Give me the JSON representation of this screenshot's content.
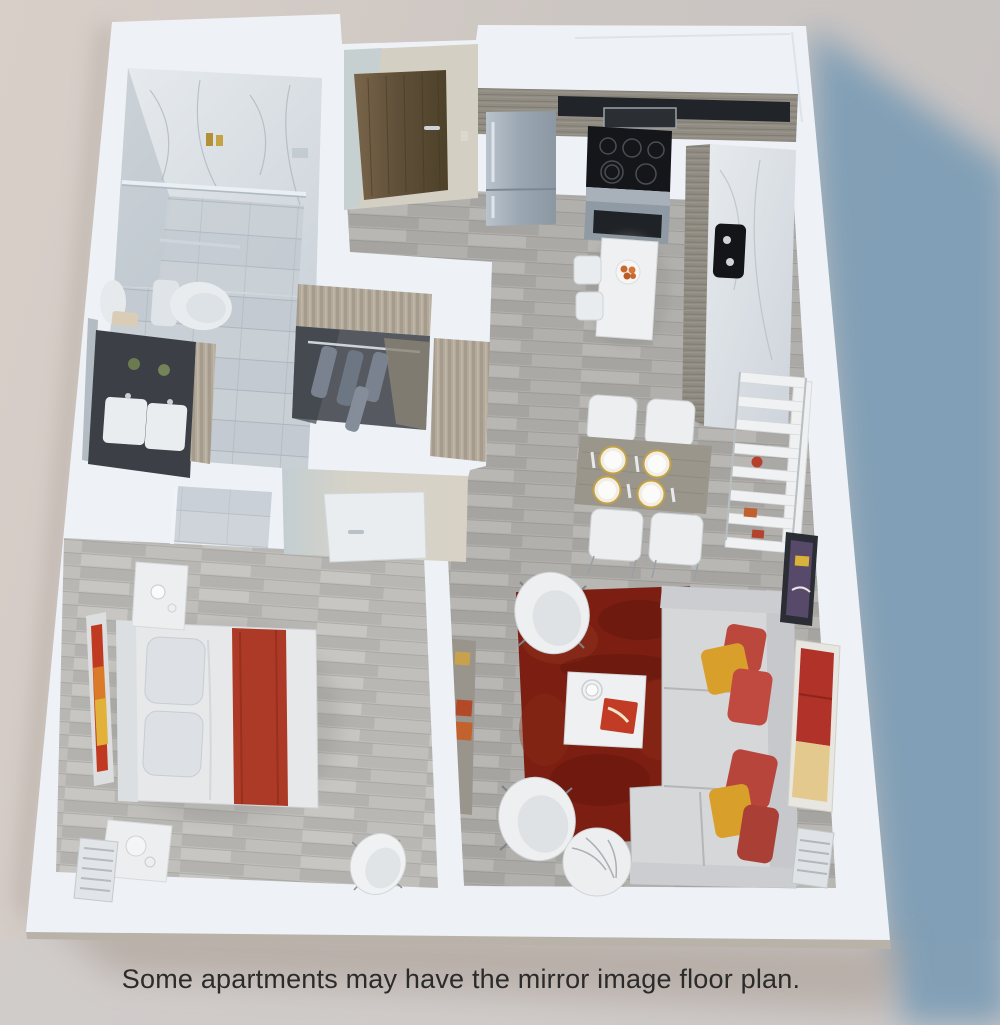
{
  "caption": {
    "text": "Some apartments may have the mirror image floor plan."
  },
  "scene": {
    "type": "3d-isometric-floor-plan-rendering",
    "rooms": [
      {
        "name": "bathroom",
        "items": [
          "walk-in shower",
          "glass divider",
          "toilet",
          "double vanity",
          "linen cabinet",
          "mirror"
        ]
      },
      {
        "name": "walk-in-closet",
        "items": [
          "clothes rod",
          "hanging clothes"
        ]
      },
      {
        "name": "entry",
        "items": [
          "wood entry door",
          "light switch"
        ]
      },
      {
        "name": "kitchen",
        "items": [
          "refrigerator",
          "microwave",
          "range",
          "oven",
          "black sink",
          "counter",
          "breakfast table",
          "two stools",
          "fruit bowl"
        ]
      },
      {
        "name": "dining-area",
        "items": [
          "dining table",
          "four chairs",
          "four place settings",
          "leaning shelf unit"
        ]
      },
      {
        "name": "living-room",
        "items": [
          "red area rug",
          "sectional sofa",
          "accent pillows",
          "coffee table",
          "two barrel chairs",
          "round marble side table",
          "tv console",
          "radiator",
          "wall art"
        ]
      },
      {
        "name": "bedroom",
        "items": [
          "bed with red throw",
          "nightstand",
          "desk",
          "radiator",
          "tv console",
          "shell chair",
          "wall art",
          "door"
        ]
      }
    ]
  },
  "colors": {
    "background_left": "#d8cec8",
    "background_right": "#c7c3c2",
    "wall_white": "#eef2f7",
    "slab_edge": "#b9b2a9",
    "shadow_blue": "#7b9cb5",
    "contact_shadow": "#a89a90",
    "floor_wood": "#b1b0ad",
    "floor_wood_light": "#bfbeba",
    "bathroom_tile": "#c3cad1",
    "marble": "#d9dfe4",
    "closet_floor": "#565a60",
    "cabinet_wood": "#8f8b82",
    "stainless": "#a3aeb8",
    "cooktop_black": "#151619",
    "door_wood": "#6a5940",
    "rug_red": "#7c1f12",
    "sofa_gray": "#d6d7d9",
    "pillow_red": "#bb473d",
    "pillow_gold": "#d8a02b",
    "bed_white": "#e6e8ea",
    "bed_throw_red": "#ad3a26",
    "vanity_charcoal": "#3c4046",
    "dining_table_wood": "#9b968c",
    "caption_text": "#2b2b2b"
  }
}
